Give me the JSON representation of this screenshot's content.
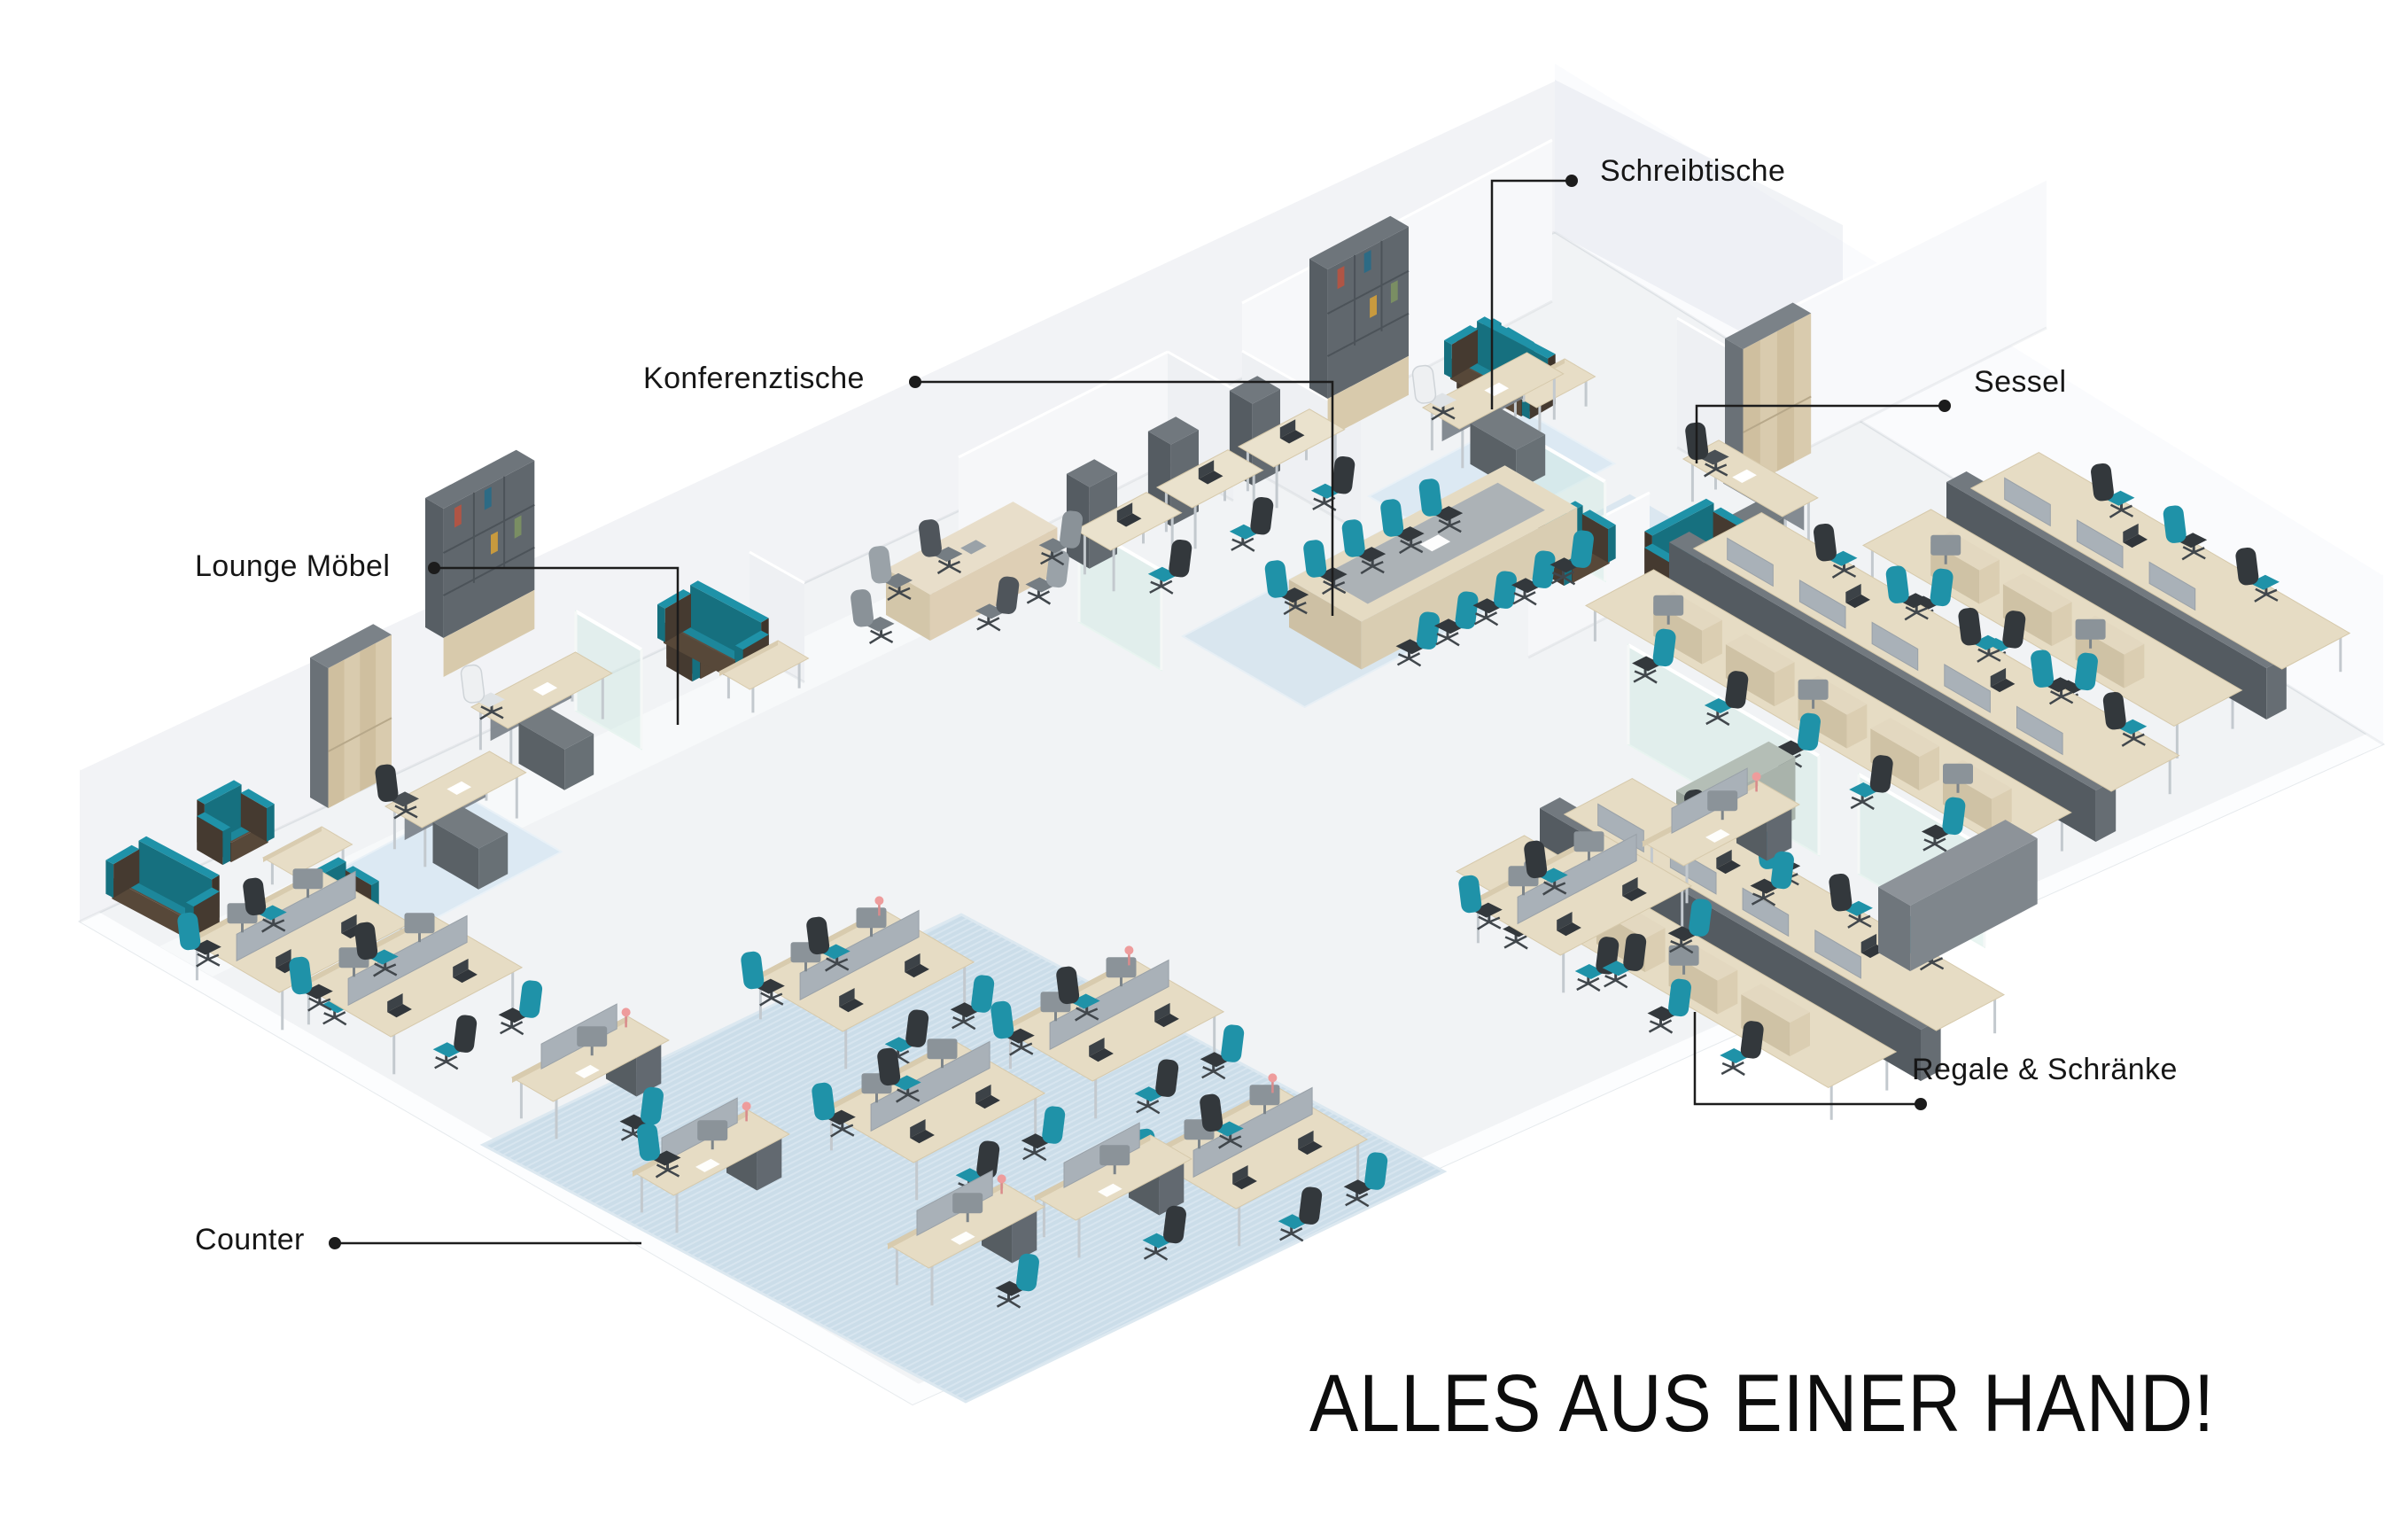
{
  "slogan": "ALLES AUS EINER HAND!",
  "labels": {
    "schreibtische": "Schreibtische",
    "konferenztische": "Konferenztische",
    "sessel": "Sessel",
    "lounge_moebel": "Lounge Möbel",
    "regale_schraenke": "Regale & Schränke",
    "counter": "Counter"
  },
  "colors": {
    "background": "#ffffff",
    "text": "#161616",
    "leader_line": "#1c1c1c",
    "accent_teal": "#1f92a8",
    "teal_dark": "#16707f",
    "chair_charcoal": "#33383c",
    "wood_light": "#e6dcc4",
    "wood_shadow": "#d6c9ab",
    "cabinet_gray": "#6e767c",
    "sofa_brown": "#4e4036",
    "carpet_blue": "#dce9f3",
    "carpet_blue_big": "#cbdde9",
    "floor_gray": "#f1f3f5",
    "wall_white": "#f5f6f8",
    "glass_tint": "rgba(206,232,226,0.45)",
    "lamp_pink": "#ee9c9c"
  }
}
